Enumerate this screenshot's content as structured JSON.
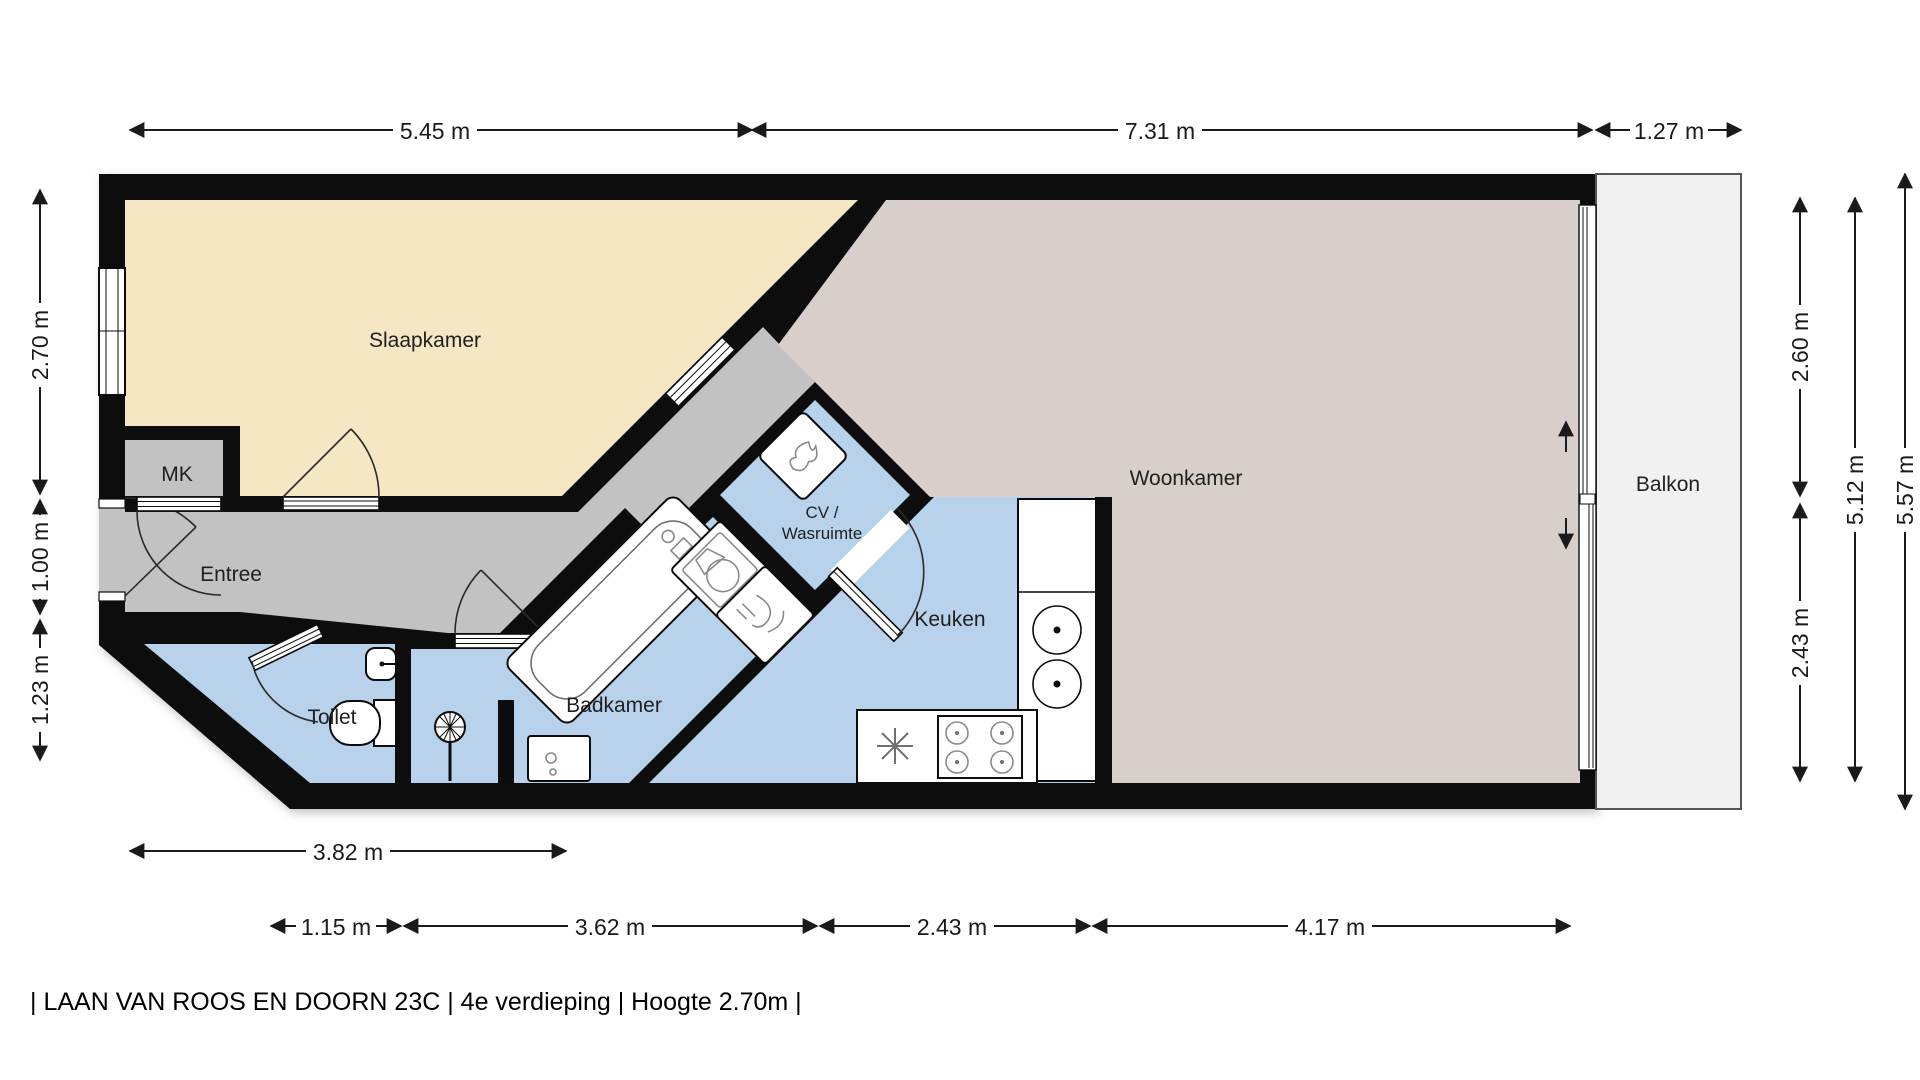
{
  "plan": {
    "footer": "| LAAN VAN ROOS EN DOORN 23C | 4e verdieping | Hoogte 2.70m |",
    "colors": {
      "wall": "#0c0c0c",
      "bedroom_floor": "#f5e7c3",
      "living_floor": "#d8cfca",
      "hall_floor": "#c3c2c2",
      "wet_room_floor": "#b7d2ea",
      "balcony_floor": "#f1f1f1",
      "text": "#1a1a1a"
    },
    "rooms": {
      "slaapkamer": {
        "label": "Slaapkamer"
      },
      "woonkamer": {
        "label": "Woonkamer"
      },
      "entree": {
        "label": "Entree"
      },
      "mk": {
        "label": "MK"
      },
      "toilet": {
        "label": "Toilet"
      },
      "badkamer": {
        "label": "Badkamer"
      },
      "cv": {
        "label_line1": "CV /",
        "label_line2": "Wasruimte"
      },
      "keuken": {
        "label": "Keuken"
      },
      "balkon": {
        "label": "Balkon"
      }
    },
    "dimensions": {
      "top": [
        {
          "label": "5.45 m"
        },
        {
          "label": "7.31 m"
        },
        {
          "label": "1.27 m"
        }
      ],
      "left": [
        {
          "label": "2.70 m"
        },
        {
          "label": "1.00 m"
        },
        {
          "label": "1.23 m"
        }
      ],
      "right": [
        {
          "label": "2.60 m"
        },
        {
          "label": "2.43 m"
        },
        {
          "label": "5.12 m"
        },
        {
          "label": "5.57 m"
        }
      ],
      "bottom": [
        {
          "label": "3.82 m"
        },
        {
          "label": "1.15 m"
        },
        {
          "label": "3.62 m"
        },
        {
          "label": "2.43 m"
        },
        {
          "label": "4.17 m"
        }
      ]
    },
    "fixtures": [
      {
        "name": "bathtub-icon"
      },
      {
        "name": "washing-machine-icon"
      },
      {
        "name": "dryer-icon"
      },
      {
        "name": "boiler-icon"
      },
      {
        "name": "toilet-icon"
      },
      {
        "name": "hand-basin-icon"
      },
      {
        "name": "design-radiator-icon"
      },
      {
        "name": "vanity-unit-icon"
      },
      {
        "name": "double-sink-icon"
      },
      {
        "name": "gas-stove-icon"
      },
      {
        "name": "freezer-icon"
      },
      {
        "name": "window-icon"
      },
      {
        "name": "door-icon"
      },
      {
        "name": "sliding-door-icon"
      }
    ]
  }
}
